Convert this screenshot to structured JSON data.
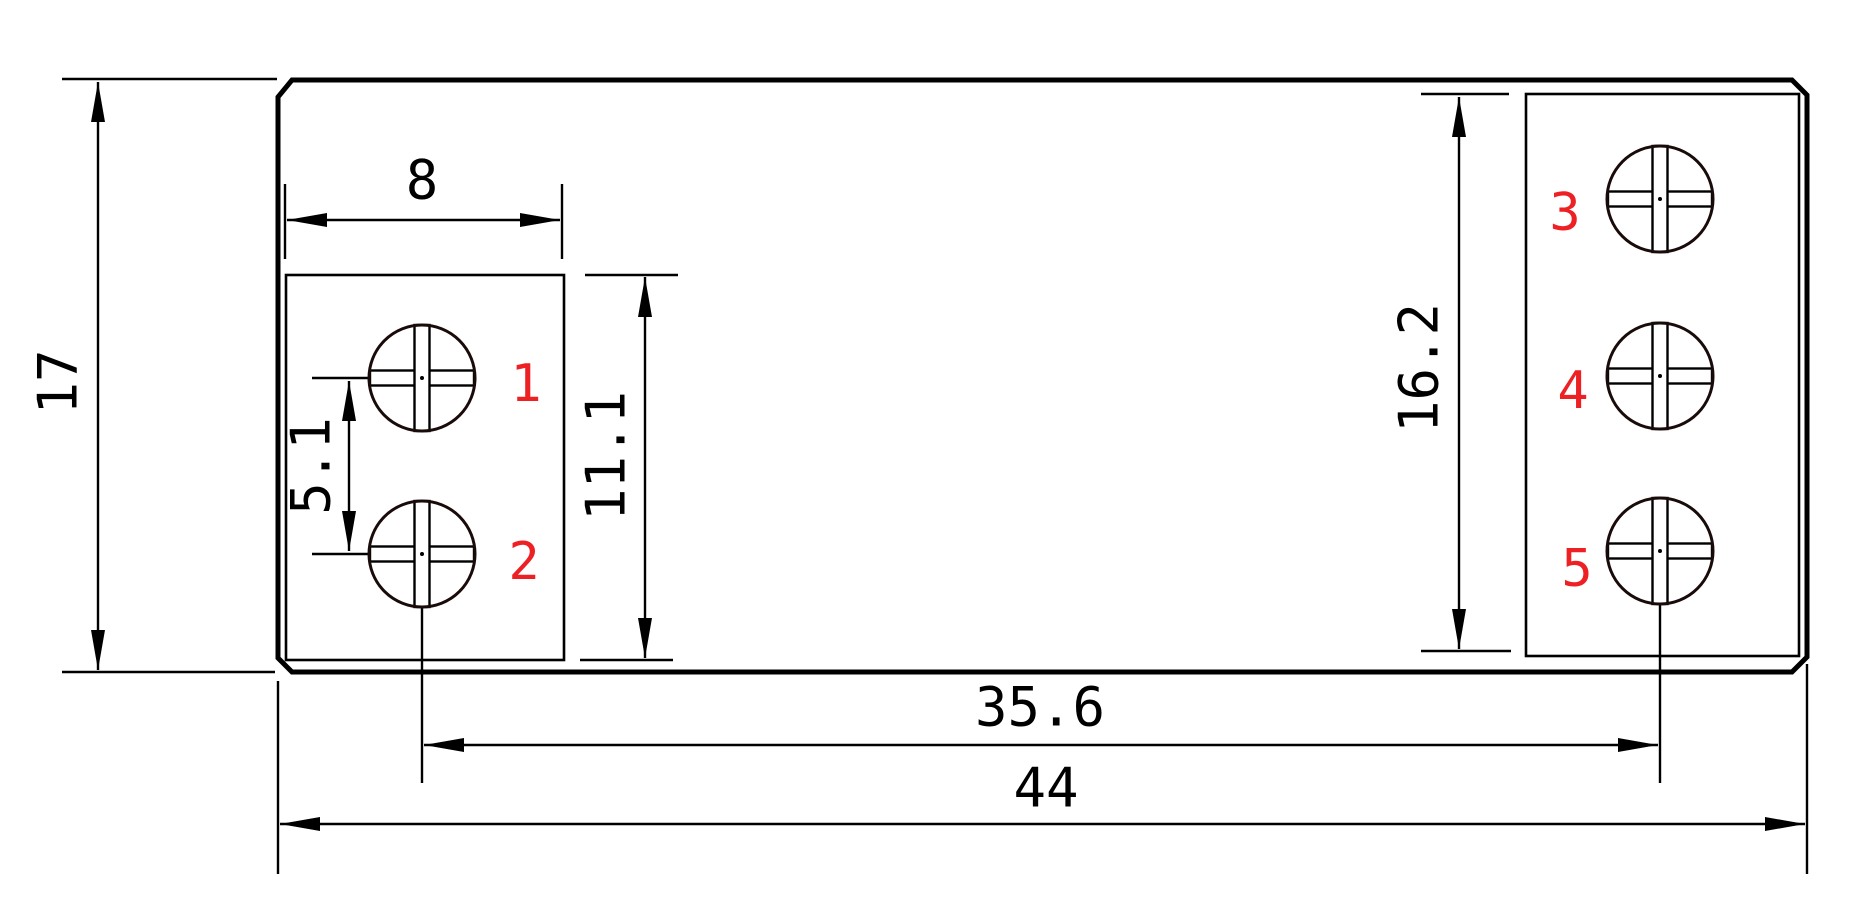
{
  "drawing": {
    "colors": {
      "line": "#000000",
      "terminal_outline": "#1a0b0b",
      "label_red": "#ed2024",
      "background": "#ffffff"
    },
    "dimensions": {
      "overall_width": "44",
      "overall_height": "17",
      "left_block_width": "8",
      "left_block_height": "11.1",
      "left_terminal_pitch": "5.1",
      "right_block_height": "16.2",
      "terminal_span": "35.6"
    },
    "terminal_labels": [
      "1",
      "2",
      "3",
      "4",
      "5"
    ]
  }
}
